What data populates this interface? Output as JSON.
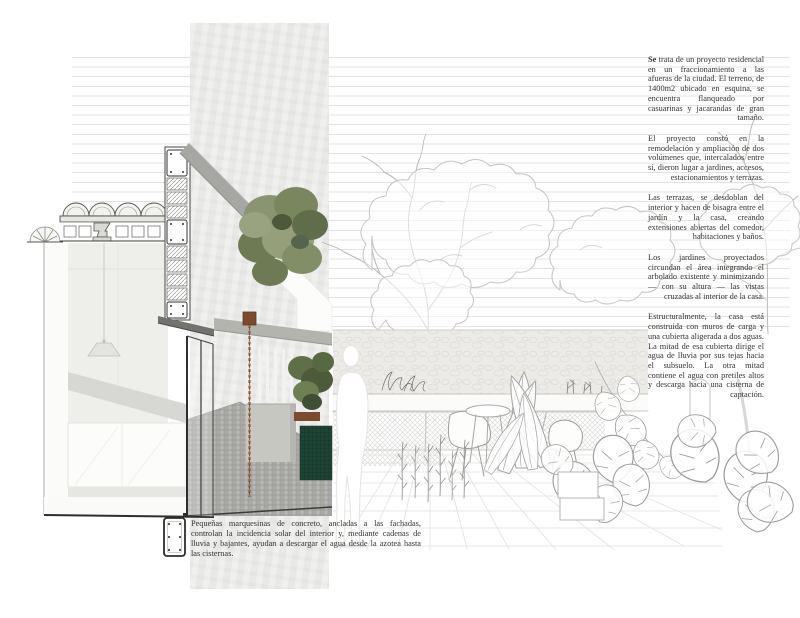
{
  "page": {
    "type": "architecture-presentation-board",
    "background": "#ffffff"
  },
  "description_column": {
    "paragraphs": [
      {
        "lead": "Se",
        "rest": " trata de un proyecto residencial en un fraccionamiento a las afueras de la ciudad. El terreno, de 1400m2 ubicado en esquina, se encuentra flanqueado por casuarinas y jacarandas de gran tamaño."
      },
      {
        "lead": "",
        "rest": "El proyecto constó en la remodelación y ampliación de dos volúmenes que, intercalados entre sí, dieron lugar a jardines, accesos, estacionamientos y terrazas."
      },
      {
        "lead": "",
        "rest": "Las terrazas, se desdoblan del interior y hacen de bisagra entre el jardín y la casa, creando extensiones abiertas del comedor, habitaciones y baños."
      },
      {
        "lead": "",
        "rest": "Los jardines proyectados circundan el área integrando el arbolado existente y minimizando — con su altura — las vistas cruzadas al interior de la casa."
      },
      {
        "lead": "",
        "rest": "Estructuralmente, la casa está construida con muros de carga y una cubierta aligerada a dos aguas. La mitad de esa cubierta dirige el agua de lluvia por sus tejas hacia el subsuelo. La otra mitad contiene el agua con pretiles altos y descarga hacia una cisterna de captación."
      }
    ]
  },
  "caption": {
    "text": "Pequeñas marquesinas de concreto, ancladas a las fachadas, controlan la incidencia solar del interior y, mediante cadenas de lluvia y bajantes, ayudan a descargar el agua desde la azotea hasta las cisternas."
  },
  "artwork": {
    "elements": [
      "building-section-drawing",
      "vaulted-ceiling-detail",
      "wall-section-column",
      "pendant-lamp",
      "cabinet",
      "glass-facade",
      "sloped-roof-slab",
      "concrete-canopy",
      "rain-chain",
      "pergola-slats",
      "planter-wall",
      "water-spout",
      "green-tile-fountain",
      "cobblestone-paving",
      "tree-photo-collage",
      "foliage-photo",
      "human-figure-silhouette",
      "garden-line-drawing",
      "bare-tree-sketch",
      "leafy-tree-sketch",
      "stone-wall-sketch",
      "bench-ledge",
      "tiled-floor-grid",
      "eames-chair-sketch",
      "round-table-sketch",
      "banana-plant-sketch",
      "monstera-plant-sketch",
      "arched-door-sketch",
      "planter-boxes",
      "rebar-detail-icon"
    ],
    "colors": {
      "paper_band": "#e9e9e7",
      "ruled_line": "#e3e3e1",
      "roof_slab": "#a6a6a2",
      "canopy_concrete": "#b4b4af",
      "dark_bracket": "#72726e",
      "rain_chain": "#9a6038",
      "wood_spout": "#7c4b2e",
      "green_tiles": "#1d4434",
      "foliage_green": "#6d7a54",
      "paver_gray": "#a8a8a5",
      "sketch_line": "#b6b6b3",
      "text": "#333331"
    }
  }
}
